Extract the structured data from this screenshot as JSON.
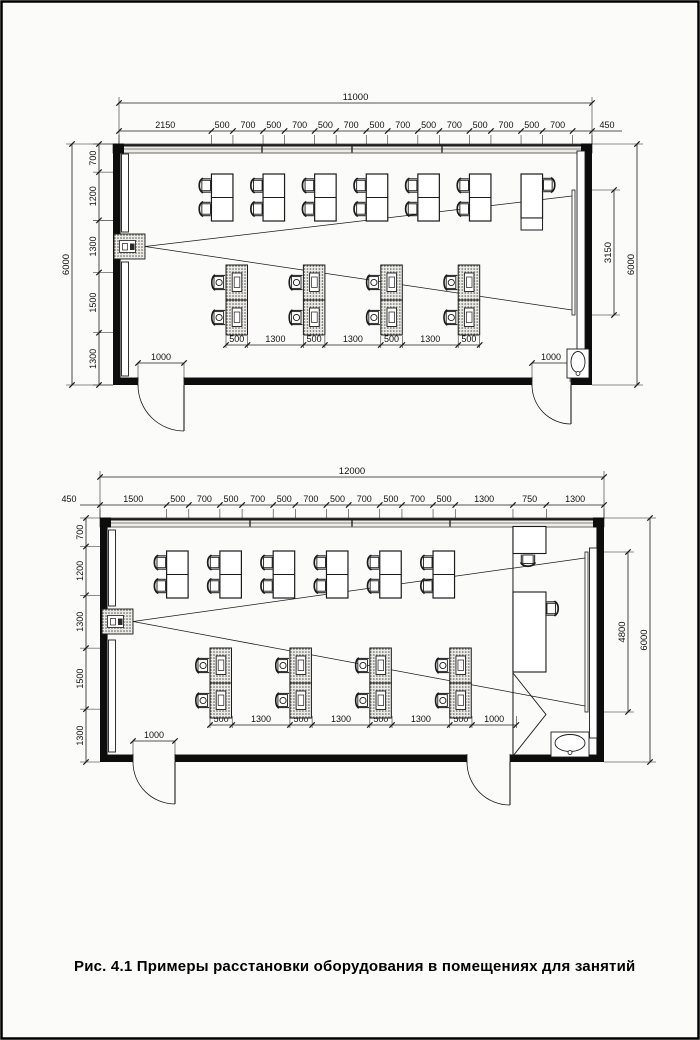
{
  "caption": "Рис. 4.1 Примеры расстановки оборудования в помещениях для занятий",
  "plan_top": {
    "overall_width": "11000",
    "top_chain": [
      "2150",
      "500",
      "700",
      "500",
      "700",
      "500",
      "700",
      "500",
      "700",
      "500",
      "700",
      "500",
      "700",
      "500",
      "700",
      "450"
    ],
    "left_overall": "6000",
    "left_chain": [
      "700",
      "1200",
      "1300",
      "1500",
      "1300"
    ],
    "right_overall": "6000",
    "screen_dim": "3150",
    "bottom_chain": [
      "500",
      "1300",
      "500",
      "1300",
      "500",
      "1300",
      "500"
    ],
    "door_left_dim": "1000",
    "door_right_dim": "1000"
  },
  "plan_bottom": {
    "overall_width": "12000",
    "left_overhang": "450",
    "top_chain": [
      "1500",
      "500",
      "700",
      "500",
      "700",
      "500",
      "700",
      "500",
      "700",
      "500",
      "700",
      "500",
      "1300",
      "750",
      "1300"
    ],
    "left_chain": [
      "700",
      "1200",
      "1300",
      "1500",
      "1300"
    ],
    "right_overall": "6000",
    "screen_dim": "4800",
    "bottom_chain": [
      "500",
      "1300",
      "500",
      "1300",
      "500",
      "1300",
      "500",
      "1000"
    ],
    "door_left_dim": "1000"
  }
}
